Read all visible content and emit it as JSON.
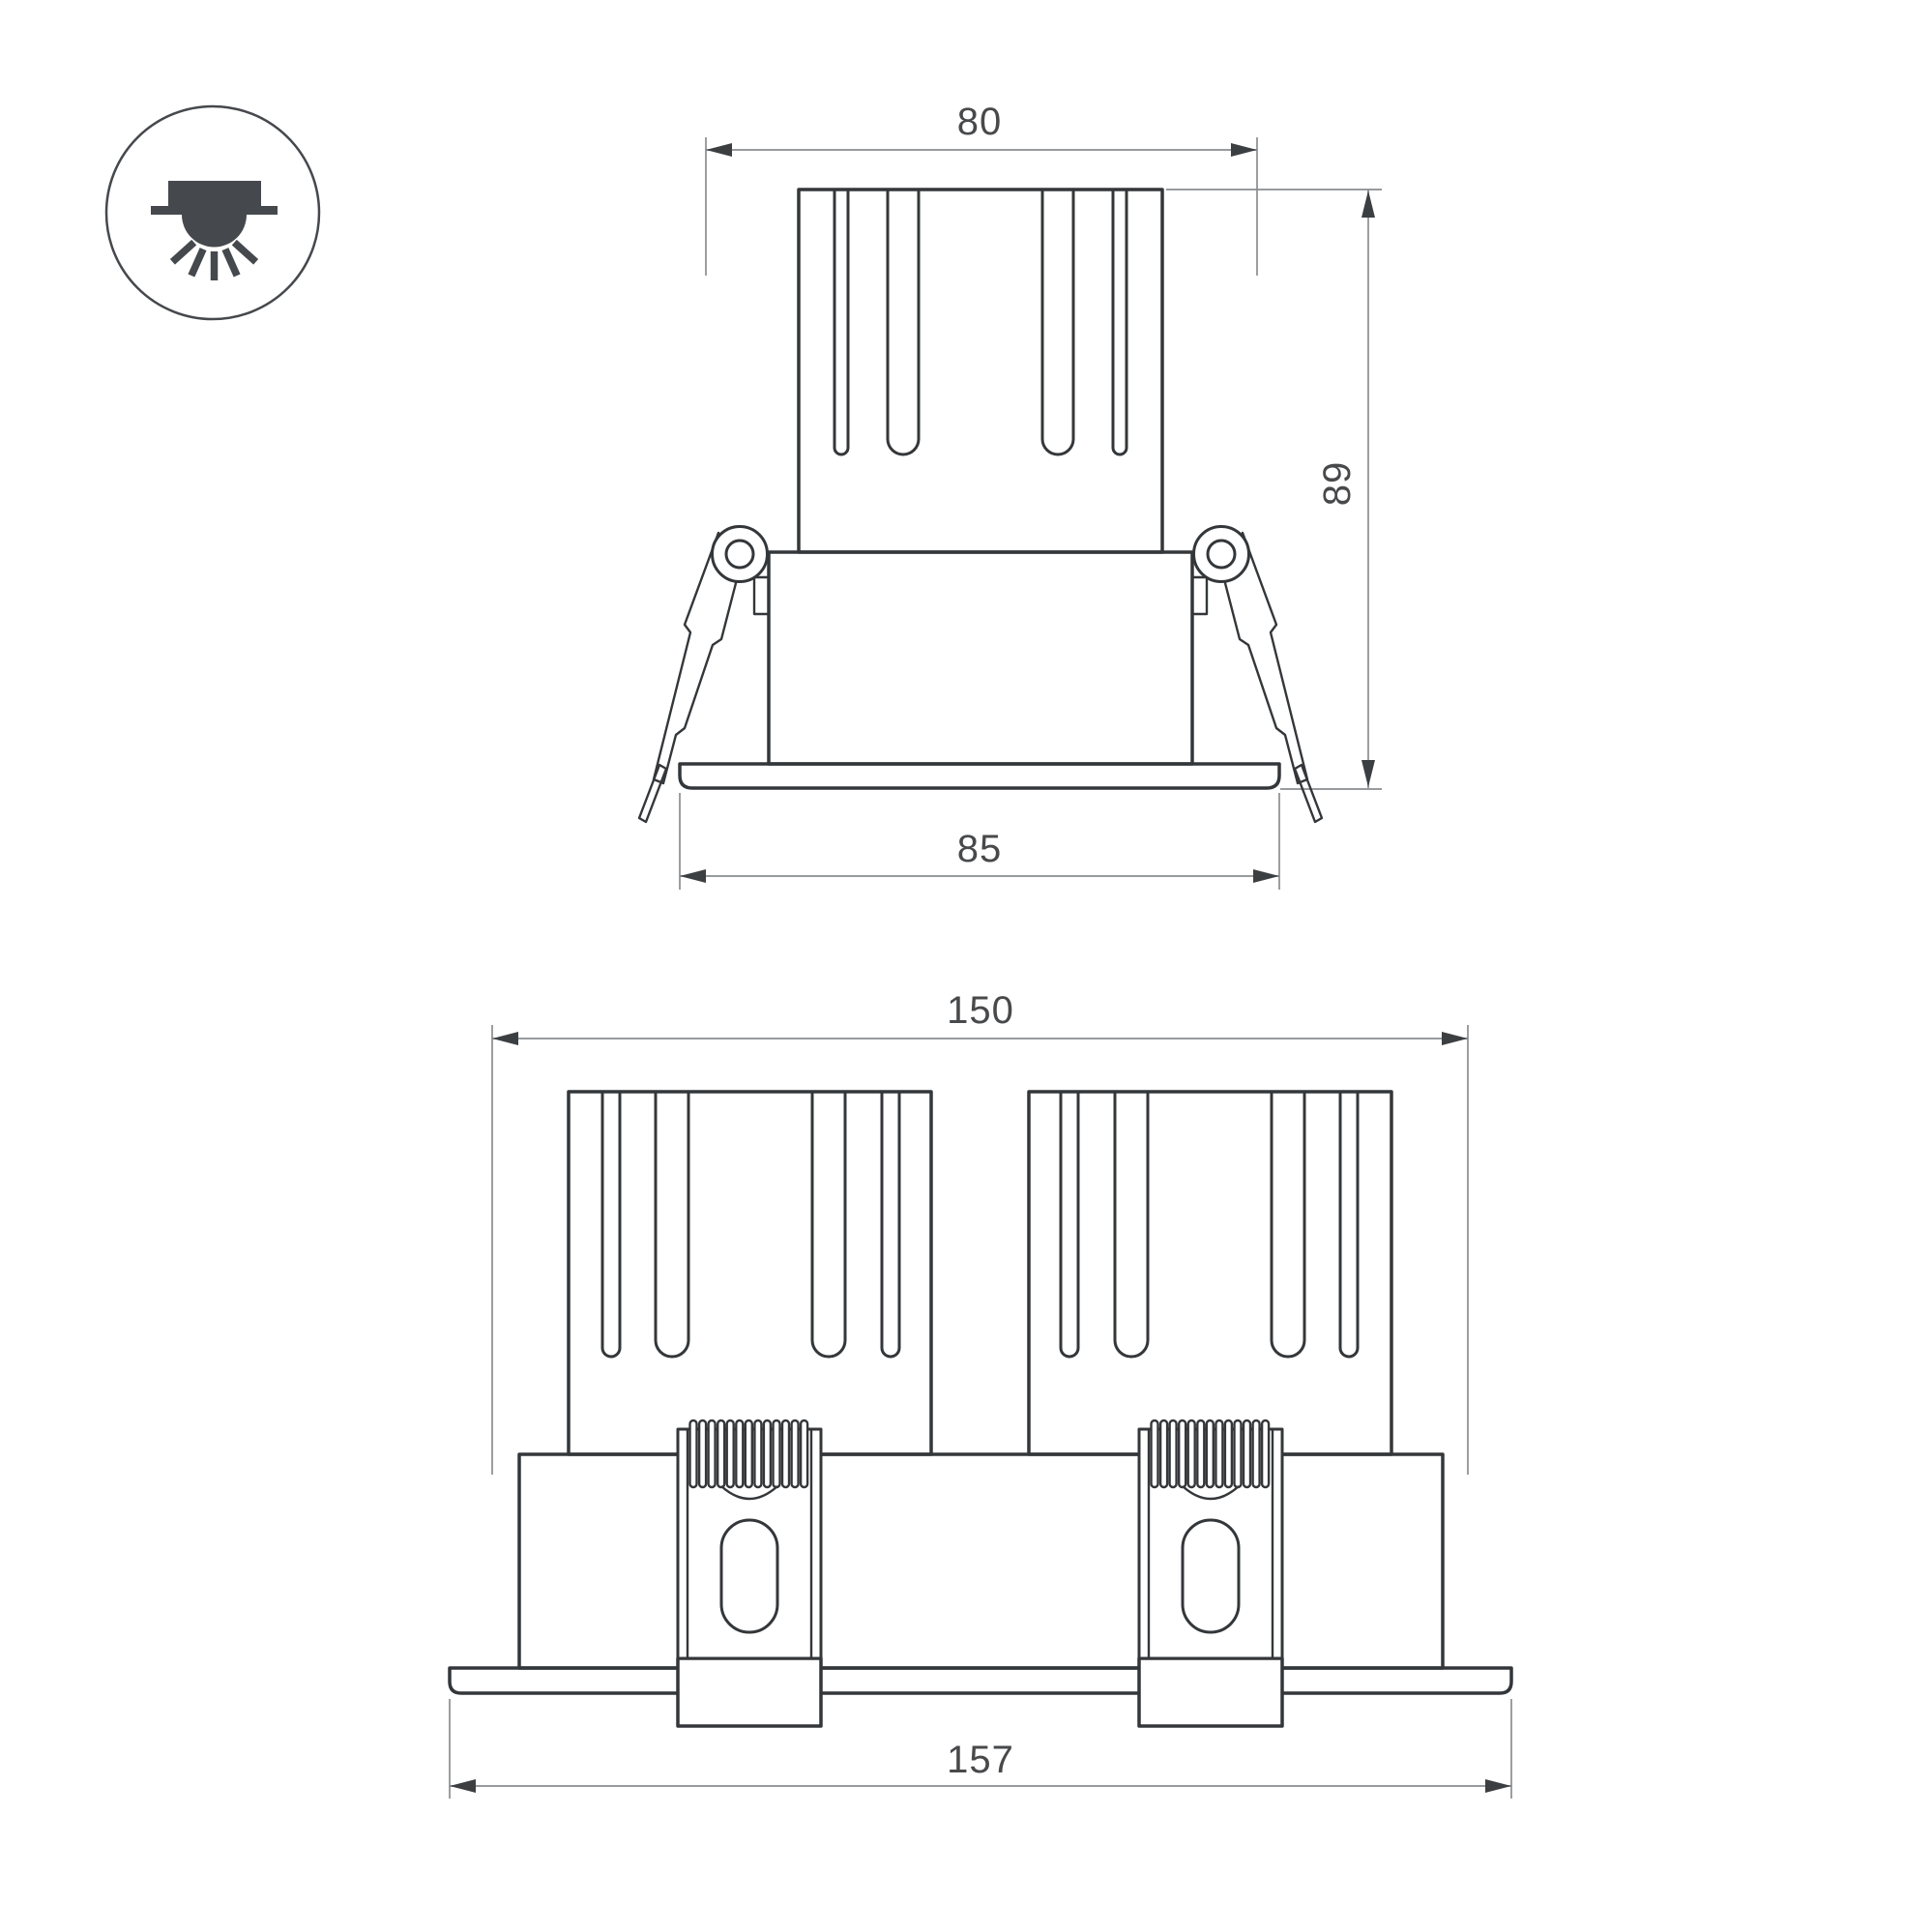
{
  "meta": {
    "kind": "technical-dimension-drawing",
    "subject": "recessed-downlight-luminaire"
  },
  "colors": {
    "background": "#ffffff",
    "object_line": "#34373a",
    "dimension_line": "#8a8d8f",
    "arrow": "#3c3f42",
    "text": "#48494b",
    "icon": "#45484c"
  },
  "icon": {
    "name": "recessed-downlight-icon"
  },
  "views": {
    "front": {
      "title": "single-module-front-view",
      "dimensions": {
        "top_width": {
          "label": "80"
        },
        "height": {
          "label": "89"
        },
        "trim_width": {
          "label": "85"
        }
      }
    },
    "double": {
      "title": "twin-module-front-view",
      "dimensions": {
        "overall_width": {
          "label": "150"
        },
        "flange_width": {
          "label": "157"
        }
      }
    }
  }
}
